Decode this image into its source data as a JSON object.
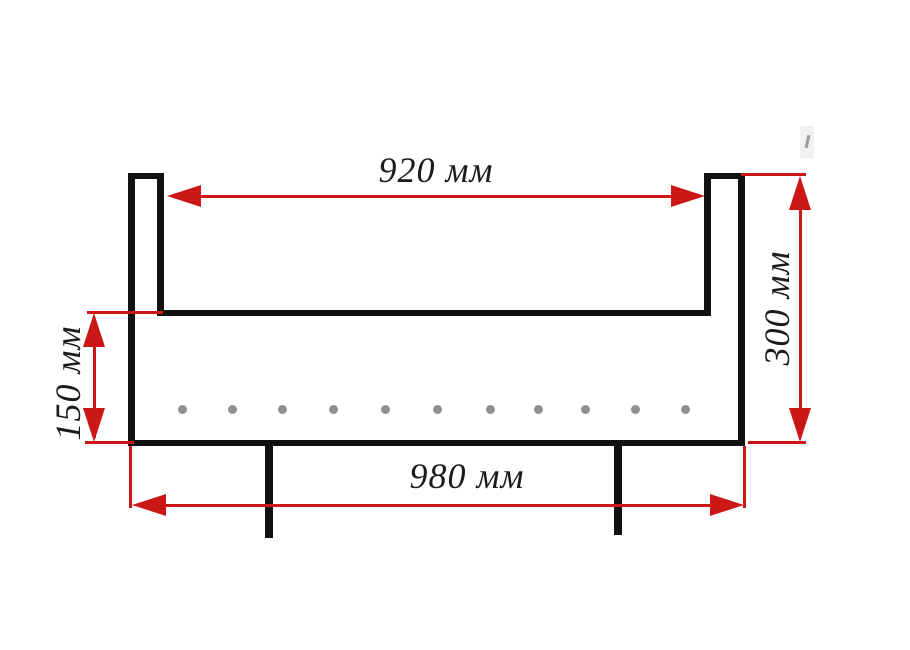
{
  "diagram": {
    "type": "dimensional-drawing",
    "subject": "U-shaped brazier box cross-section with legs and air holes",
    "unit": "мм",
    "dimensions": {
      "inner_width": {
        "label": "920 мм",
        "value": 920,
        "unit": "мм",
        "orientation": "horizontal"
      },
      "total_height": {
        "label": "300 мм",
        "value": 300,
        "unit": "мм",
        "orientation": "vertical"
      },
      "lower_height": {
        "label": "150 мм",
        "value": 150,
        "unit": "мм",
        "orientation": "vertical"
      },
      "overall_width": {
        "label": "980 мм",
        "value": 980,
        "unit": "мм",
        "orientation": "horizontal"
      }
    },
    "holes": {
      "count": 11,
      "shape": "circle",
      "diameter_px": 9,
      "y_center": 409,
      "x_centers": [
        182,
        232,
        282,
        333,
        385,
        437,
        490,
        538,
        585,
        635,
        685
      ]
    },
    "legs": {
      "count": 2
    }
  },
  "colors": {
    "outline": "#111111",
    "dimension_red": "#cc1717",
    "hole_gray": "#8f8f8f",
    "background": "#ffffff"
  }
}
